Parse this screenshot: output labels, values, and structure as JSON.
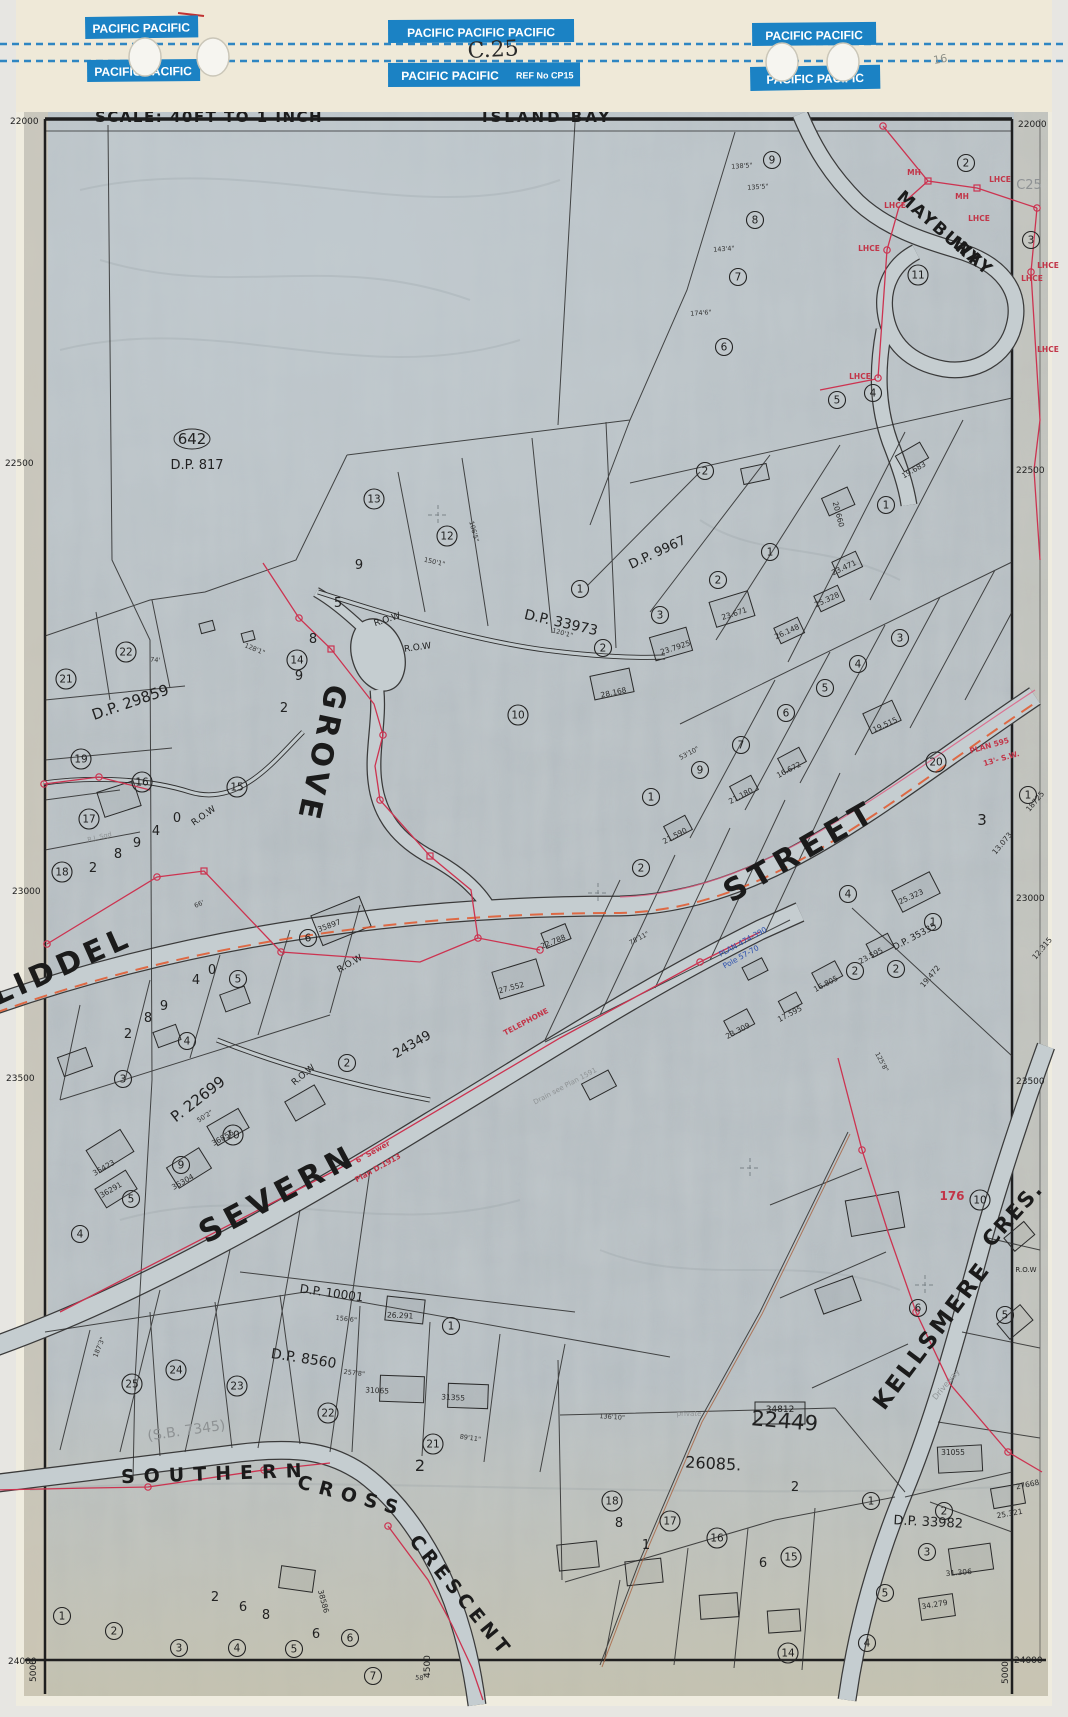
{
  "tape": {
    "code_handwritten": "C.25",
    "ref_label": "REF No CP15",
    "pencil_note": "16.",
    "strips": [
      {
        "text": "PACIFIC  PACIFIC"
      },
      {
        "text": "PACIFIC  PACIFIC  PACIFIC"
      },
      {
        "text": "PACIFIC  PACIFIC"
      },
      {
        "text": "PACIFIC  PACIFIC"
      },
      {
        "text": "PACIFIC  PACIFIC"
      },
      {
        "text": "PACIFIC  PACIFIC"
      }
    ]
  },
  "map": {
    "scale_text": "SCALE: 40FT TO 1 INCH",
    "locality": "ISLAND BAY",
    "sheet_pencil_code": "C25",
    "edge_labels": [
      {
        "t": "22000",
        "x": 10,
        "y": 124
      },
      {
        "t": "22000",
        "x": 1018,
        "y": 127
      },
      {
        "t": "22500",
        "x": 5,
        "y": 466
      },
      {
        "t": "22500",
        "x": 1016,
        "y": 473
      },
      {
        "t": "23000",
        "x": 12,
        "y": 894
      },
      {
        "t": "23000",
        "x": 1016,
        "y": 901
      },
      {
        "t": "23500",
        "x": 6,
        "y": 1081
      },
      {
        "t": "23500",
        "x": 1016,
        "y": 1084
      },
      {
        "t": "24000",
        "x": 8,
        "y": 1664
      },
      {
        "t": "24000",
        "x": 1014,
        "y": 1663
      },
      {
        "t": "5000",
        "x": 36,
        "y": 1682,
        "r": -90
      },
      {
        "t": "4500",
        "x": 430,
        "y": 1678,
        "r": -90
      },
      {
        "t": "5000",
        "x": 1008,
        "y": 1684,
        "r": -90
      }
    ],
    "streets": [
      {
        "label": "LIDDEL",
        "x": 66,
        "y": 975,
        "r": -24,
        "s": 30,
        "ls": 5
      },
      {
        "label": "STREET",
        "x": 806,
        "y": 860,
        "r": -30,
        "s": 31,
        "ls": 7
      },
      {
        "label": "SEVERN",
        "x": 283,
        "y": 1203,
        "r": -28,
        "s": 31,
        "ls": 6
      },
      {
        "label": "GROVE",
        "x": 312,
        "y": 752,
        "r": 102,
        "s": 30,
        "ls": 5
      },
      {
        "label": "KELLSMERE",
        "x": 938,
        "y": 1340,
        "r": -53,
        "s": 23,
        "ls": 3
      },
      {
        "label": "CRES.",
        "x": 1018,
        "y": 1219,
        "r": -48,
        "s": 21,
        "ls": 2
      },
      {
        "label": "SOUTHERN",
        "x": 216,
        "y": 1480,
        "r": -2,
        "s": 19,
        "ls": 9
      },
      {
        "label": "CROSS",
        "x": 350,
        "y": 1502,
        "r": 15,
        "s": 19,
        "ls": 8
      },
      {
        "label": "CRESCENT",
        "x": 456,
        "y": 1600,
        "r": 51,
        "s": 19,
        "ls": 5
      },
      {
        "label": "MAYBURY",
        "x": 936,
        "y": 233,
        "r": 41,
        "s": 17,
        "ls": 2
      },
      {
        "label": "WAY",
        "x": 969,
        "y": 261,
        "r": 41,
        "s": 17,
        "ls": 2
      }
    ],
    "plan_labels": [
      {
        "t": "642",
        "x": 192,
        "y": 444,
        "s": 15,
        "oval": true
      },
      {
        "t": "D.P. 817",
        "x": 197,
        "y": 469,
        "s": 13
      },
      {
        "t": "D.P. 29859",
        "x": 132,
        "y": 707,
        "r": -19,
        "s": 15
      },
      {
        "t": "D.P. 33973",
        "x": 560,
        "y": 627,
        "r": 13,
        "s": 14
      },
      {
        "t": "D.P. 9967",
        "x": 659,
        "y": 556,
        "r": -25,
        "s": 13
      },
      {
        "t": "P. 22699",
        "x": 201,
        "y": 1103,
        "r": -38,
        "s": 15
      },
      {
        "t": "24349",
        "x": 414,
        "y": 1048,
        "r": -30,
        "s": 13
      },
      {
        "t": "D.P. 8560",
        "x": 303,
        "y": 1363,
        "r": 9,
        "s": 14
      },
      {
        "t": "D.P. 10001",
        "x": 331,
        "y": 1297,
        "r": 8,
        "s": 12
      },
      {
        "t": "26085.",
        "x": 713,
        "y": 1469,
        "r": 3,
        "s": 16
      },
      {
        "t": "22449",
        "x": 784,
        "y": 1428,
        "r": 5,
        "s": 21
      },
      {
        "t": "D.P. 33982",
        "x": 928,
        "y": 1526,
        "r": 3,
        "s": 13
      },
      {
        "t": "D.P. 35335",
        "x": 916,
        "y": 939,
        "r": -28,
        "s": 9
      },
      {
        "t": "34812",
        "x": 780,
        "y": 1412,
        "s": 9
      }
    ],
    "row_labels": [
      {
        "t": "R.O.W",
        "x": 388,
        "y": 622,
        "r": -18
      },
      {
        "t": "R.O.W",
        "x": 418,
        "y": 650,
        "r": -8
      },
      {
        "t": "R.O.W",
        "x": 205,
        "y": 818,
        "r": -35
      },
      {
        "t": "R.O.W",
        "x": 305,
        "y": 1077,
        "r": -40
      },
      {
        "t": "R.O.W",
        "x": 351,
        "y": 966,
        "r": -30
      },
      {
        "t": "R.O.W",
        "x": 1026,
        "y": 1272,
        "s": 7
      }
    ],
    "lots_circled": [
      {
        "n": "9",
        "x": 772,
        "y": 160
      },
      {
        "n": "2",
        "x": 966,
        "y": 163
      },
      {
        "n": "8",
        "x": 755,
        "y": 220
      },
      {
        "n": "3",
        "x": 1031,
        "y": 240
      },
      {
        "n": "7",
        "x": 738,
        "y": 277
      },
      {
        "n": "11",
        "x": 918,
        "y": 275
      },
      {
        "n": "6",
        "x": 724,
        "y": 347
      },
      {
        "n": "5",
        "x": 837,
        "y": 400
      },
      {
        "n": "4",
        "x": 873,
        "y": 393
      },
      {
        "n": "1",
        "x": 886,
        "y": 505
      },
      {
        "n": "13",
        "x": 374,
        "y": 499
      },
      {
        "n": "12",
        "x": 447,
        "y": 536
      },
      {
        "n": "1",
        "x": 580,
        "y": 589
      },
      {
        "n": "2",
        "x": 603,
        "y": 648
      },
      {
        "n": "14",
        "x": 297,
        "y": 660
      },
      {
        "n": "10",
        "x": 518,
        "y": 715
      },
      {
        "n": "22",
        "x": 126,
        "y": 652
      },
      {
        "n": "21",
        "x": 66,
        "y": 679
      },
      {
        "n": "19",
        "x": 81,
        "y": 759
      },
      {
        "n": "16",
        "x": 142,
        "y": 782
      },
      {
        "n": "15",
        "x": 237,
        "y": 787
      },
      {
        "n": "17",
        "x": 89,
        "y": 819
      },
      {
        "n": "18",
        "x": 62,
        "y": 872
      },
      {
        "n": "2",
        "x": 705,
        "y": 471
      },
      {
        "n": "1",
        "x": 770,
        "y": 552
      },
      {
        "n": "2",
        "x": 718,
        "y": 580
      },
      {
        "n": "3",
        "x": 660,
        "y": 615
      },
      {
        "n": "3",
        "x": 900,
        "y": 638
      },
      {
        "n": "4",
        "x": 858,
        "y": 664
      },
      {
        "n": "5",
        "x": 825,
        "y": 688
      },
      {
        "n": "6",
        "x": 786,
        "y": 713
      },
      {
        "n": "7",
        "x": 741,
        "y": 745
      },
      {
        "n": "9",
        "x": 700,
        "y": 770
      },
      {
        "n": "1",
        "x": 651,
        "y": 797
      },
      {
        "n": "2",
        "x": 641,
        "y": 868
      },
      {
        "n": "1",
        "x": 1028,
        "y": 795
      },
      {
        "n": "2",
        "x": 855,
        "y": 971
      },
      {
        "n": "1",
        "x": 933,
        "y": 922
      },
      {
        "n": "2",
        "x": 896,
        "y": 969
      },
      {
        "n": "4",
        "x": 848,
        "y": 894
      },
      {
        "n": "20",
        "x": 936,
        "y": 762
      },
      {
        "n": "6",
        "x": 308,
        "y": 938
      },
      {
        "n": "5",
        "x": 238,
        "y": 979
      },
      {
        "n": "4",
        "x": 187,
        "y": 1041
      },
      {
        "n": "3",
        "x": 123,
        "y": 1079
      },
      {
        "n": "2",
        "x": 347,
        "y": 1063
      },
      {
        "n": "10",
        "x": 233,
        "y": 1135
      },
      {
        "n": "9",
        "x": 181,
        "y": 1165
      },
      {
        "n": "5",
        "x": 131,
        "y": 1199
      },
      {
        "n": "4",
        "x": 80,
        "y": 1234
      },
      {
        "n": "24",
        "x": 176,
        "y": 1370
      },
      {
        "n": "25",
        "x": 132,
        "y": 1384
      },
      {
        "n": "23",
        "x": 237,
        "y": 1386
      },
      {
        "n": "22",
        "x": 328,
        "y": 1413
      },
      {
        "n": "21",
        "x": 433,
        "y": 1444
      },
      {
        "n": "1",
        "x": 451,
        "y": 1326
      },
      {
        "n": "18",
        "x": 612,
        "y": 1501
      },
      {
        "n": "17",
        "x": 670,
        "y": 1521
      },
      {
        "n": "16",
        "x": 717,
        "y": 1538
      },
      {
        "n": "15",
        "x": 791,
        "y": 1557
      },
      {
        "n": "1",
        "x": 871,
        "y": 1501
      },
      {
        "n": "2",
        "x": 944,
        "y": 1511
      },
      {
        "n": "3",
        "x": 927,
        "y": 1552
      },
      {
        "n": "5",
        "x": 885,
        "y": 1593
      },
      {
        "n": "4",
        "x": 867,
        "y": 1643
      },
      {
        "n": "14",
        "x": 788,
        "y": 1653
      },
      {
        "n": "1",
        "x": 62,
        "y": 1616
      },
      {
        "n": "2",
        "x": 114,
        "y": 1631
      },
      {
        "n": "3",
        "x": 179,
        "y": 1648
      },
      {
        "n": "4",
        "x": 237,
        "y": 1648
      },
      {
        "n": "5",
        "x": 294,
        "y": 1649
      },
      {
        "n": "6",
        "x": 350,
        "y": 1638
      },
      {
        "n": "7",
        "x": 373,
        "y": 1676
      },
      {
        "n": "10",
        "x": 980,
        "y": 1200
      },
      {
        "n": "6",
        "x": 918,
        "y": 1308
      },
      {
        "n": "5",
        "x": 1005,
        "y": 1315
      }
    ],
    "lots_plain": [
      {
        "t": "9",
        "x": 359,
        "y": 569
      },
      {
        "t": "5",
        "x": 338,
        "y": 607
      },
      {
        "t": "8",
        "x": 313,
        "y": 643
      },
      {
        "t": "9",
        "x": 299,
        "y": 680
      },
      {
        "t": "2",
        "x": 284,
        "y": 712
      },
      {
        "t": "0",
        "x": 177,
        "y": 822
      },
      {
        "t": "4",
        "x": 156,
        "y": 835
      },
      {
        "t": "9",
        "x": 137,
        "y": 847
      },
      {
        "t": "8",
        "x": 118,
        "y": 858
      },
      {
        "t": "2",
        "x": 93,
        "y": 872
      },
      {
        "t": "0",
        "x": 212,
        "y": 974
      },
      {
        "t": "4",
        "x": 196,
        "y": 984
      },
      {
        "t": "9",
        "x": 164,
        "y": 1010
      },
      {
        "t": "8",
        "x": 148,
        "y": 1022
      },
      {
        "t": "2",
        "x": 128,
        "y": 1038
      },
      {
        "t": "2",
        "x": 420,
        "y": 1471,
        "s": 16
      },
      {
        "t": "2",
        "x": 795,
        "y": 1491
      },
      {
        "t": "8",
        "x": 619,
        "y": 1527
      },
      {
        "t": "6",
        "x": 763,
        "y": 1567
      },
      {
        "t": "1",
        "x": 646,
        "y": 1549
      },
      {
        "t": "2",
        "x": 215,
        "y": 1601
      },
      {
        "t": "6",
        "x": 243,
        "y": 1611
      },
      {
        "t": "8",
        "x": 266,
        "y": 1619
      },
      {
        "t": "6",
        "x": 316,
        "y": 1638
      },
      {
        "t": "3",
        "x": 982,
        "y": 825,
        "s": 15
      }
    ],
    "house_numbers": [
      {
        "t": "35897",
        "x": 330,
        "y": 928,
        "r": -20
      },
      {
        "t": "27.552",
        "x": 512,
        "y": 990,
        "r": -15
      },
      {
        "t": "22.788",
        "x": 554,
        "y": 944,
        "r": -22
      },
      {
        "t": "25.323",
        "x": 912,
        "y": 899,
        "r": -25
      },
      {
        "t": "23.671",
        "x": 735,
        "y": 616,
        "r": -18
      },
      {
        "t": "23.7925",
        "x": 676,
        "y": 650,
        "r": -18
      },
      {
        "t": "28.168",
        "x": 614,
        "y": 695,
        "r": -12
      },
      {
        "t": "19.515",
        "x": 886,
        "y": 727,
        "r": -25
      },
      {
        "t": "20.660",
        "x": 836,
        "y": 515,
        "r": 75
      },
      {
        "t": "19.683",
        "x": 915,
        "y": 472,
        "r": -30
      },
      {
        "t": "23.471",
        "x": 845,
        "y": 570,
        "r": -25
      },
      {
        "t": "25.328",
        "x": 828,
        "y": 602,
        "r": -25
      },
      {
        "t": "26.148",
        "x": 788,
        "y": 634,
        "r": -25
      },
      {
        "t": "16.672",
        "x": 790,
        "y": 772,
        "r": -28
      },
      {
        "t": "21.180",
        "x": 742,
        "y": 798,
        "r": -28
      },
      {
        "t": "21.590",
        "x": 676,
        "y": 838,
        "r": -28
      },
      {
        "t": "16.805",
        "x": 827,
        "y": 986,
        "r": -28
      },
      {
        "t": "23.309",
        "x": 739,
        "y": 1033,
        "r": -28
      },
      {
        "t": "17.595",
        "x": 791,
        "y": 1016,
        "r": -28
      },
      {
        "t": "23.595",
        "x": 872,
        "y": 958,
        "r": -28
      },
      {
        "t": "35423",
        "x": 105,
        "y": 1170,
        "r": -30
      },
      {
        "t": "36291",
        "x": 112,
        "y": 1192,
        "r": -30
      },
      {
        "t": "36304",
        "x": 184,
        "y": 1184,
        "r": -30
      },
      {
        "t": "36856",
        "x": 224,
        "y": 1140,
        "r": -30
      },
      {
        "t": "26.291",
        "x": 400,
        "y": 1318,
        "r": 3
      },
      {
        "t": "31065",
        "x": 377,
        "y": 1393,
        "r": 3
      },
      {
        "t": "31355",
        "x": 453,
        "y": 1400,
        "r": 3
      },
      {
        "t": "38586",
        "x": 321,
        "y": 1602,
        "r": 75
      },
      {
        "t": "31055",
        "x": 953,
        "y": 1455
      },
      {
        "t": "31.306",
        "x": 959,
        "y": 1575,
        "r": -5
      },
      {
        "t": "25.321",
        "x": 1010,
        "y": 1516,
        "r": -10
      },
      {
        "t": "27668",
        "x": 1028,
        "y": 1487,
        "r": -12
      },
      {
        "t": "34.279",
        "x": 935,
        "y": 1607,
        "r": -10
      },
      {
        "t": "13.073",
        "x": 1004,
        "y": 845,
        "r": -50
      },
      {
        "t": "18725",
        "x": 1037,
        "y": 803,
        "r": -50
      },
      {
        "t": "12.315",
        "x": 1044,
        "y": 950,
        "r": -50
      },
      {
        "t": "19.472",
        "x": 932,
        "y": 978,
        "r": -50
      }
    ],
    "dims": [
      {
        "t": "138'5\"",
        "x": 742,
        "y": 168,
        "r": -4
      },
      {
        "t": "135'5\"",
        "x": 758,
        "y": 189,
        "r": -4
      },
      {
        "t": "143'4\"",
        "x": 724,
        "y": 251,
        "r": -4
      },
      {
        "t": "174'6\"",
        "x": 701,
        "y": 315,
        "r": -4
      },
      {
        "t": "150'1\"",
        "x": 434,
        "y": 564,
        "r": 13
      },
      {
        "t": "120'1\"",
        "x": 562,
        "y": 635,
        "r": 15
      },
      {
        "t": "128'1\"",
        "x": 254,
        "y": 651,
        "r": 22
      },
      {
        "t": "106'5\"",
        "x": 472,
        "y": 532,
        "r": 75
      },
      {
        "t": "66'",
        "x": 200,
        "y": 906,
        "r": -24
      },
      {
        "t": "257'8\"",
        "x": 354,
        "y": 1375,
        "r": 7
      },
      {
        "t": "156'6\"",
        "x": 346,
        "y": 1321,
        "r": 7
      },
      {
        "t": "136'10\"",
        "x": 612,
        "y": 1419,
        "r": 4
      },
      {
        "t": "125'8\"",
        "x": 880,
        "y": 1063,
        "r": 62
      },
      {
        "t": "187'3\"",
        "x": 101,
        "y": 1348,
        "r": -68
      },
      {
        "t": "50'2\"",
        "x": 206,
        "y": 1118,
        "r": -33
      },
      {
        "t": "74'",
        "x": 155,
        "y": 662,
        "r": 5
      },
      {
        "t": "53'10\"",
        "x": 690,
        "y": 755,
        "r": -28
      },
      {
        "t": "78'11\"",
        "x": 640,
        "y": 940,
        "r": -28
      },
      {
        "t": "58'",
        "x": 420,
        "y": 1680,
        "r": 5
      },
      {
        "t": "89'11\"",
        "x": 470,
        "y": 1440,
        "r": 8
      }
    ],
    "red_notes": [
      {
        "t": "LHCE",
        "x": 1000,
        "y": 182
      },
      {
        "t": "LHCE",
        "x": 895,
        "y": 208
      },
      {
        "t": "LHCE",
        "x": 869,
        "y": 251
      },
      {
        "t": "LHCE",
        "x": 979,
        "y": 221
      },
      {
        "t": "LHCE",
        "x": 1048,
        "y": 268
      },
      {
        "t": "LHCE",
        "x": 1032,
        "y": 281
      },
      {
        "t": "LHCE",
        "x": 1048,
        "y": 352
      },
      {
        "t": "LHCE",
        "x": 860,
        "y": 379
      },
      {
        "t": "MH",
        "x": 914,
        "y": 175
      },
      {
        "t": "MH",
        "x": 962,
        "y": 199
      },
      {
        "t": "TELEPHONE",
        "x": 527,
        "y": 1024,
        "r": -28
      },
      {
        "t": "6\" Sewer",
        "x": 374,
        "y": 1154,
        "r": -29
      },
      {
        "t": "Plan D.1913",
        "x": 379,
        "y": 1170,
        "r": -29
      },
      {
        "t": "PLAN 595",
        "x": 990,
        "y": 748,
        "r": -16
      },
      {
        "t": "13'- S.W.",
        "x": 1002,
        "y": 761,
        "r": -16
      },
      {
        "t": "176",
        "x": 952,
        "y": 1200,
        "s": 12
      }
    ],
    "blue_notes": [
      {
        "t": "PLAN 474-390",
        "x": 744,
        "y": 944,
        "r": -29
      },
      {
        "t": "Pole 57-70",
        "x": 742,
        "y": 959,
        "r": -29
      }
    ],
    "pencil_notes": [
      {
        "t": "C25",
        "x": 1029,
        "y": 189,
        "s": 13
      },
      {
        "t": "(S.B. 7345)",
        "x": 187,
        "y": 1435,
        "r": -8,
        "s": 14
      },
      {
        "t": "Driveway",
        "x": 948,
        "y": 1386,
        "r": -50,
        "s": 8
      },
      {
        "t": "R.J. Sqd",
        "x": 100,
        "y": 839,
        "r": -14,
        "s": 6.5
      },
      {
        "t": "Drain see Plan 1591",
        "x": 566,
        "y": 1088,
        "r": -28,
        "s": 7
      },
      {
        "t": "private",
        "x": 689,
        "y": 1416,
        "s": 7
      }
    ]
  }
}
